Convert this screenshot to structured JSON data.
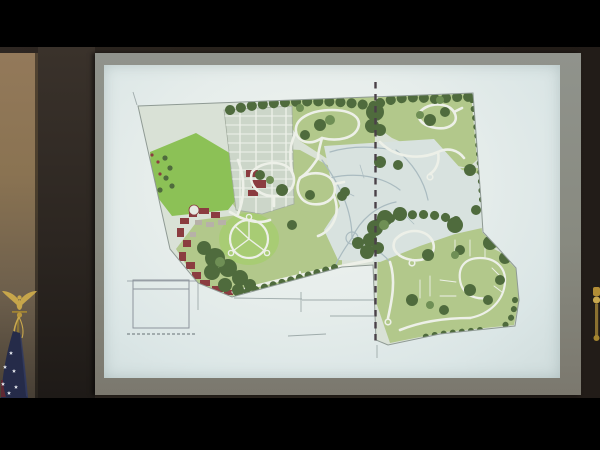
{
  "scene": {
    "type": "meeting-room-video-frame",
    "subject": "projected residential master plan drawing with flag at lower left",
    "letterbox_color": "#000000",
    "room": {
      "wall_dark": "#2c2621",
      "wall_tan_top": "#93795a",
      "wall_tan_bottom": "#473f35",
      "flag": {
        "kind": "US flag draped on pole",
        "canton": "#252b49",
        "canton_highlight": "#333b5f",
        "stripe_red": "#5e2833",
        "star": "#e2e5ec",
        "eagle_gold": "#c7a64b",
        "pole_gold": "#8a7434",
        "tassel_gold": "#c9a84e"
      },
      "right_finial_gold": "#b28d35"
    },
    "screen": {
      "frame_top": "#90938c",
      "frame_bottom": "#7b786e",
      "slide_center": "#f1f4f0",
      "slide_edge": "#cfdcdc"
    },
    "plan": {
      "kind": "residential-master-plan",
      "base_fill": "#d9e1d6",
      "boundary": "#8f9a94",
      "green_open_space": "#b2c88b",
      "meadow_green": "#8cc156",
      "lawn_green": "#a8cc74",
      "tree_dark_green": "#4f6b3d",
      "tree_light_green": "#6f8f55",
      "road_white": "#edf0e8",
      "central_pale": "#d8e2df",
      "faint_road": "#aabbc0",
      "townhouse_fill": "#ccd6c9",
      "townhouse_line": "#eef1ea",
      "village_red": "#8b3c40",
      "village_gray": "#b7b1a8",
      "phase_line_color": "#4a4148",
      "legend_line": "#8d949c",
      "survey_line": "#9fabab"
    }
  }
}
